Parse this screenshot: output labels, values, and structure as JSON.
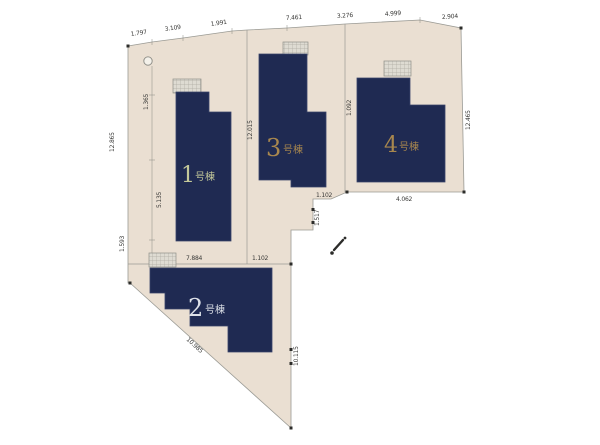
{
  "page": {
    "type": "site-plan-diagram",
    "background_color": "#ffffff"
  },
  "palette": {
    "lot_fill": "#eadfd2",
    "lot_border": "#9a9a94",
    "building_fill": "#1f2a52",
    "road_fill": "#ffffff",
    "dimension_text": "#3a3a38",
    "hatch_fill": "#dedbd2"
  },
  "plan": {
    "buildings": [
      {
        "num": "1",
        "suffix": "号棟",
        "label_color": "#c3c89a"
      },
      {
        "num": "2",
        "suffix": "号棟",
        "label_color": "#dde1e8"
      },
      {
        "num": "3",
        "suffix": "号棟",
        "label_color": "#a8874e"
      },
      {
        "num": "4",
        "suffix": "号棟",
        "label_color": "#a8874e"
      }
    ],
    "dimensions": [
      {
        "label": "1.797"
      },
      {
        "label": "3.109"
      },
      {
        "label": "1.991"
      },
      {
        "label": "7.461"
      },
      {
        "label": "3.276"
      },
      {
        "label": "4.999"
      },
      {
        "label": "2.904"
      },
      {
        "label": "12.865"
      },
      {
        "label": "1.593"
      },
      {
        "label": "5.135"
      },
      {
        "label": "12.015"
      },
      {
        "label": "1.092"
      },
      {
        "label": "12.465"
      },
      {
        "label": "1.102"
      },
      {
        "label": "1.517"
      },
      {
        "label": "4.062"
      },
      {
        "label": "7.884"
      },
      {
        "label": "1.102"
      },
      {
        "label": "10.115"
      },
      {
        "label": "10.985"
      },
      {
        "label": "1.365"
      }
    ]
  }
}
